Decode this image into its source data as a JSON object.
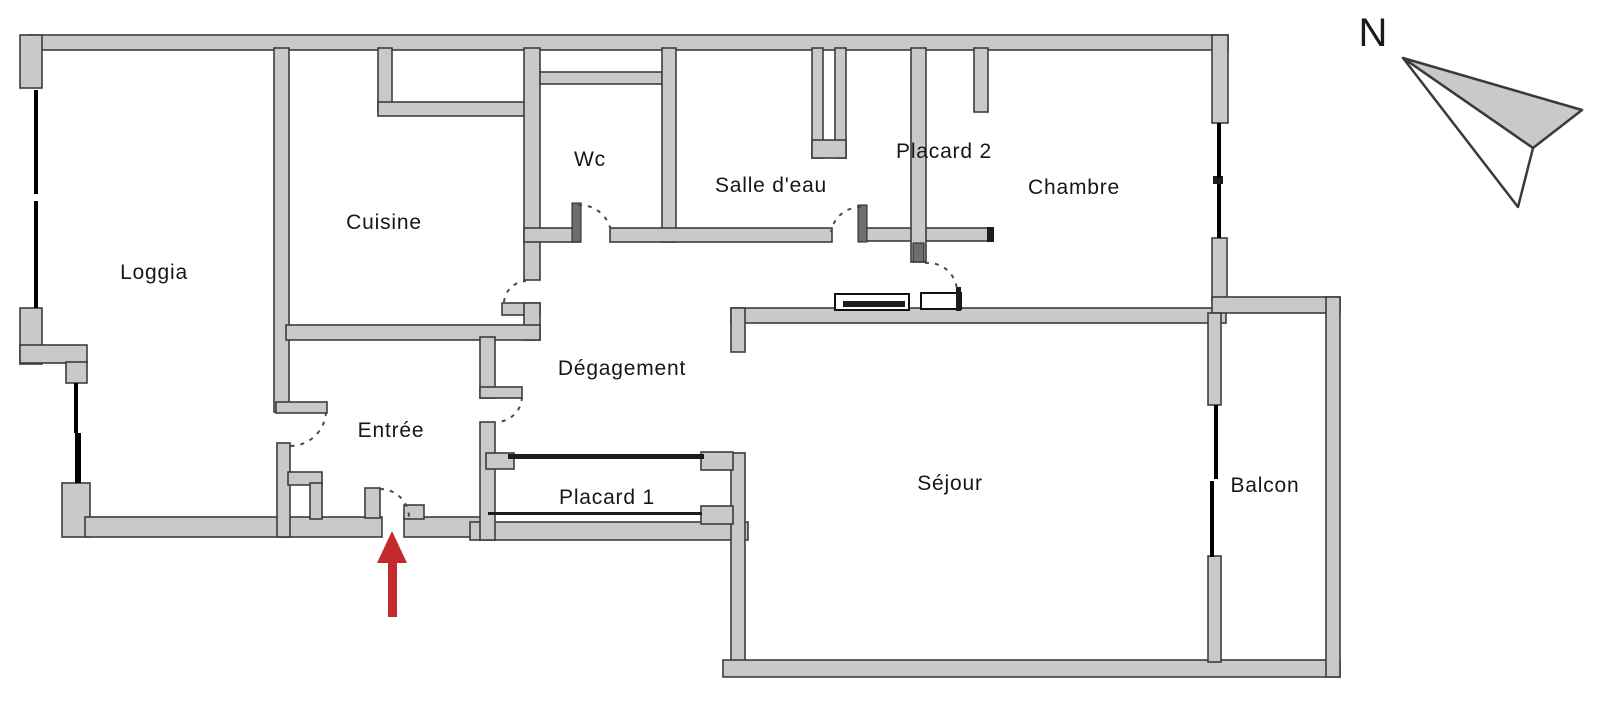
{
  "rooms": {
    "loggia": {
      "label": "Loggia"
    },
    "cuisine": {
      "label": "Cuisine"
    },
    "wc": {
      "label": "Wc"
    },
    "salle_deau": {
      "label": "Salle d'eau"
    },
    "placard2": {
      "label": "Placard 2"
    },
    "chambre": {
      "label": "Chambre"
    },
    "degagement": {
      "label": "Dégagement"
    },
    "entree": {
      "label": "Entrée"
    },
    "placard1": {
      "label": "Placard 1"
    },
    "sejour": {
      "label": "Séjour"
    },
    "balcon": {
      "label": "Balcon"
    }
  },
  "compass": {
    "label": "N"
  },
  "colors": {
    "wall_fill": "#c9c9c9",
    "wall_stroke": "#3d3d3d",
    "window": "#000000",
    "door_arc": "#4a4a4a",
    "door_leaf": "#6e6e6e",
    "detail_black": "#1c1c1c",
    "arrow_red": "#c52a2e",
    "compass_needle_fill": "#c9c9c9",
    "text": "#161616",
    "background": "#ffffff"
  }
}
